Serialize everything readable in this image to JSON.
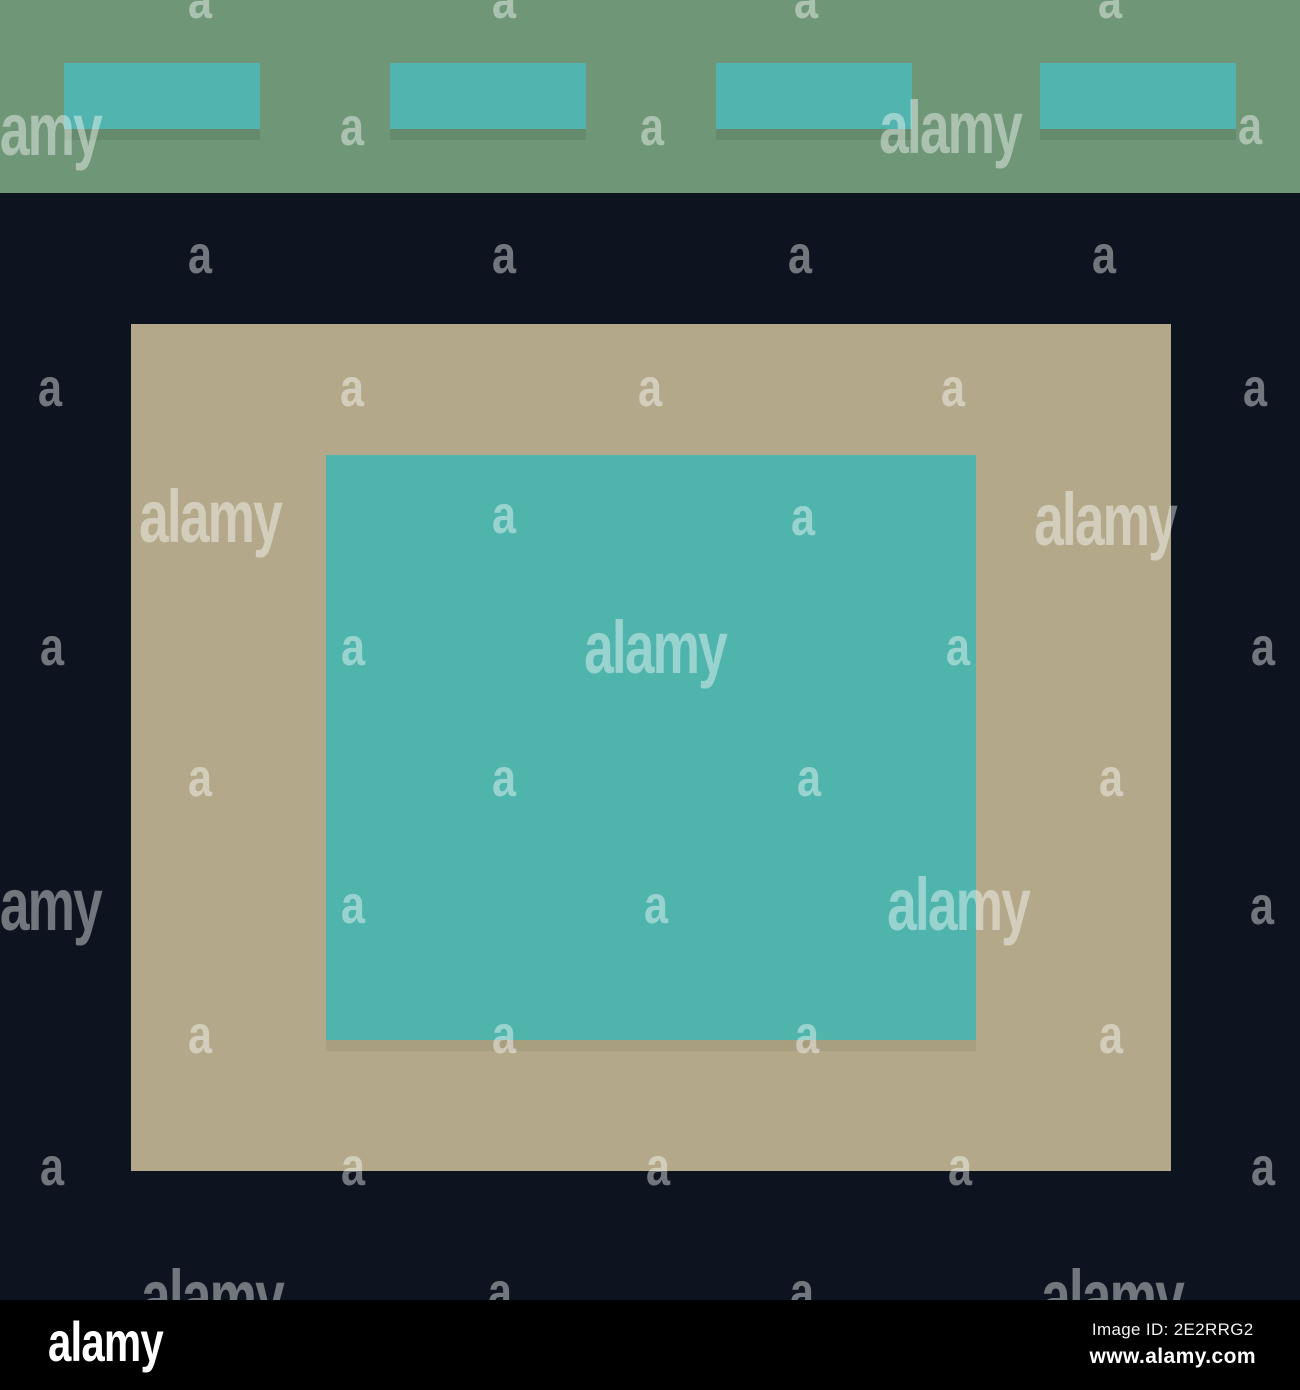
{
  "colors": {
    "background": "#0d1420",
    "header": "#6f9677",
    "button": "#52b4ae",
    "panel": "#b3a98a",
    "panel_inner": "#4eb4ac",
    "footer": "#000000",
    "watermark": "rgba(255,255,255,0.42)"
  },
  "illustration": {
    "description": "abstract pictogram of a web page: green top bar with four teal nav buttons, dark background, tan content panel with inner teal square",
    "nav_buttons": [
      {
        "left": 64
      },
      {
        "left": 390
      },
      {
        "left": 716
      },
      {
        "left": 1040
      }
    ]
  },
  "watermark": {
    "word": "alamy",
    "letter": "a",
    "words": [
      [
        30,
        130
      ],
      [
        950,
        128
      ],
      [
        210,
        517
      ],
      [
        1105,
        520
      ],
      [
        655,
        648
      ],
      [
        30,
        905
      ],
      [
        958,
        905
      ],
      [
        212,
        1297
      ],
      [
        1112,
        1297
      ]
    ],
    "letters": [
      [
        200,
        0
      ],
      [
        504,
        0
      ],
      [
        806,
        0
      ],
      [
        1110,
        0
      ],
      [
        352,
        127
      ],
      [
        652,
        127
      ],
      [
        1250,
        126
      ],
      [
        200,
        255
      ],
      [
        504,
        255
      ],
      [
        800,
        255
      ],
      [
        1104,
        255
      ],
      [
        50,
        388
      ],
      [
        352,
        388
      ],
      [
        650,
        388
      ],
      [
        953,
        388
      ],
      [
        1255,
        388
      ],
      [
        504,
        515
      ],
      [
        803,
        517
      ],
      [
        52,
        647
      ],
      [
        353,
        647
      ],
      [
        958,
        647
      ],
      [
        1263,
        647
      ],
      [
        200,
        778
      ],
      [
        504,
        778
      ],
      [
        809,
        778
      ],
      [
        1111,
        778
      ],
      [
        353,
        905
      ],
      [
        656,
        905
      ],
      [
        1262,
        906
      ],
      [
        200,
        1035
      ],
      [
        504,
        1035
      ],
      [
        807,
        1035
      ],
      [
        1111,
        1035
      ],
      [
        52,
        1167
      ],
      [
        353,
        1167
      ],
      [
        658,
        1167
      ],
      [
        960,
        1167
      ],
      [
        1263,
        1167
      ],
      [
        500,
        1292
      ],
      [
        802,
        1292
      ]
    ]
  },
  "footer": {
    "logo": "alamy",
    "image_id": "Image ID: 2E2RRG2",
    "website": "www.alamy.com"
  }
}
